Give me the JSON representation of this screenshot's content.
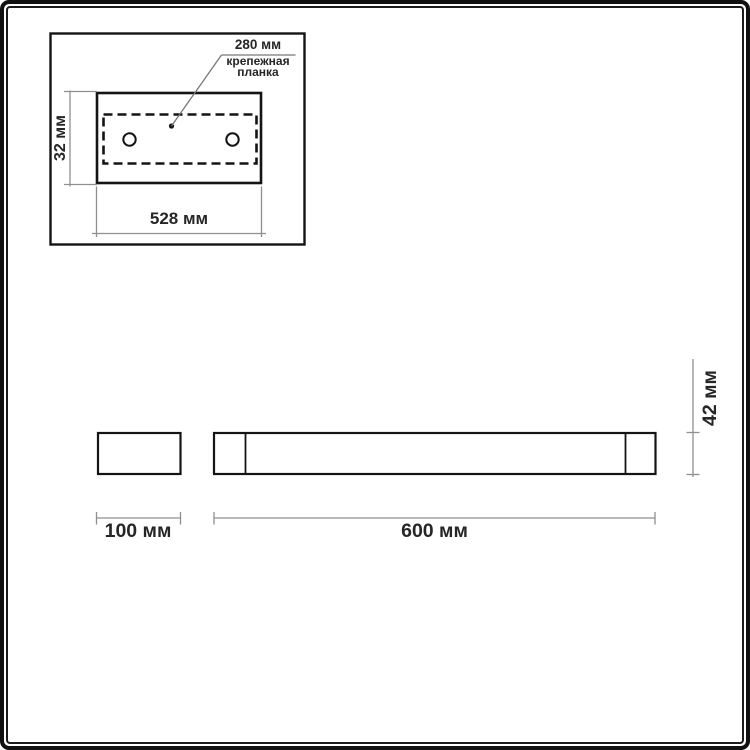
{
  "colors": {
    "background": "#ffffff",
    "frame": "#111111",
    "drawing_line": "#141414",
    "dimension_line": "#8f8f8f",
    "leader_line": "#777777",
    "text": "#262626"
  },
  "top_view": {
    "callout_value": "280 мм",
    "callout_label": "крепежная планка",
    "height_dim": "32 мм",
    "width_dim": "528 мм"
  },
  "side_view": {
    "bracket_width_dim": "100 мм",
    "body_width_dim": "600 мм",
    "height_dim": "42 мм"
  }
}
